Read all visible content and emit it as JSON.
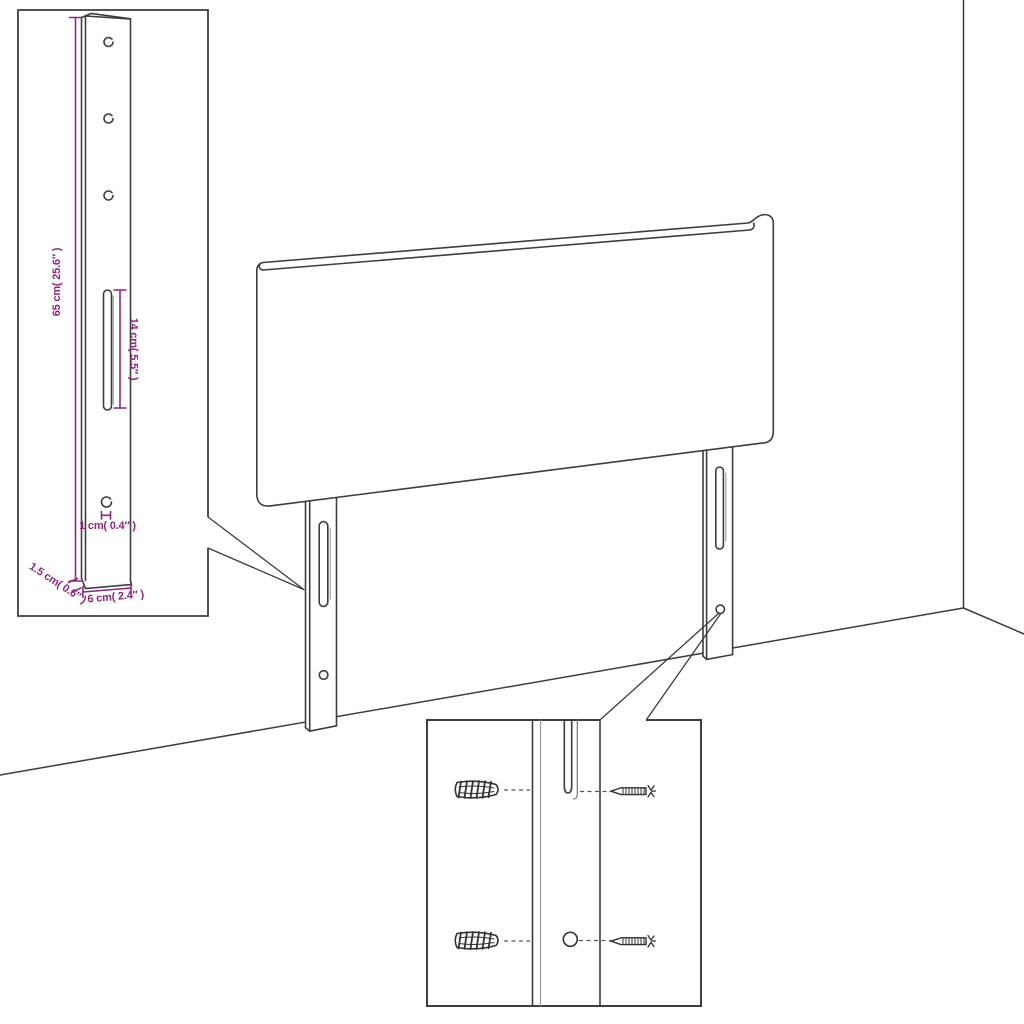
{
  "diagram": {
    "kind": "furniture dimension drawing",
    "subject": "upholstered headboard with two wall-mount legs, shown against a room corner",
    "insets": {
      "leg_detail": "enlarged side leg with drilled holes and slot",
      "mounting_detail": "wall plugs and screws aligned with leg slot and hole"
    }
  },
  "colors": {
    "line": "#3d3d3d",
    "soft_line": "#999999",
    "dimension": "#8e2583",
    "background": "#ffffff"
  },
  "leg_detail_inset": {
    "height_label": "65 cm( 25.6″ )",
    "slot_length_label": "14 cm( 5.5″ )",
    "hole_diameter_label": "1 cm( 0.4″ )",
    "thickness_label": "1.5 cm( 0.6″ )",
    "width_label": "6 cm( 2.4″ )"
  }
}
